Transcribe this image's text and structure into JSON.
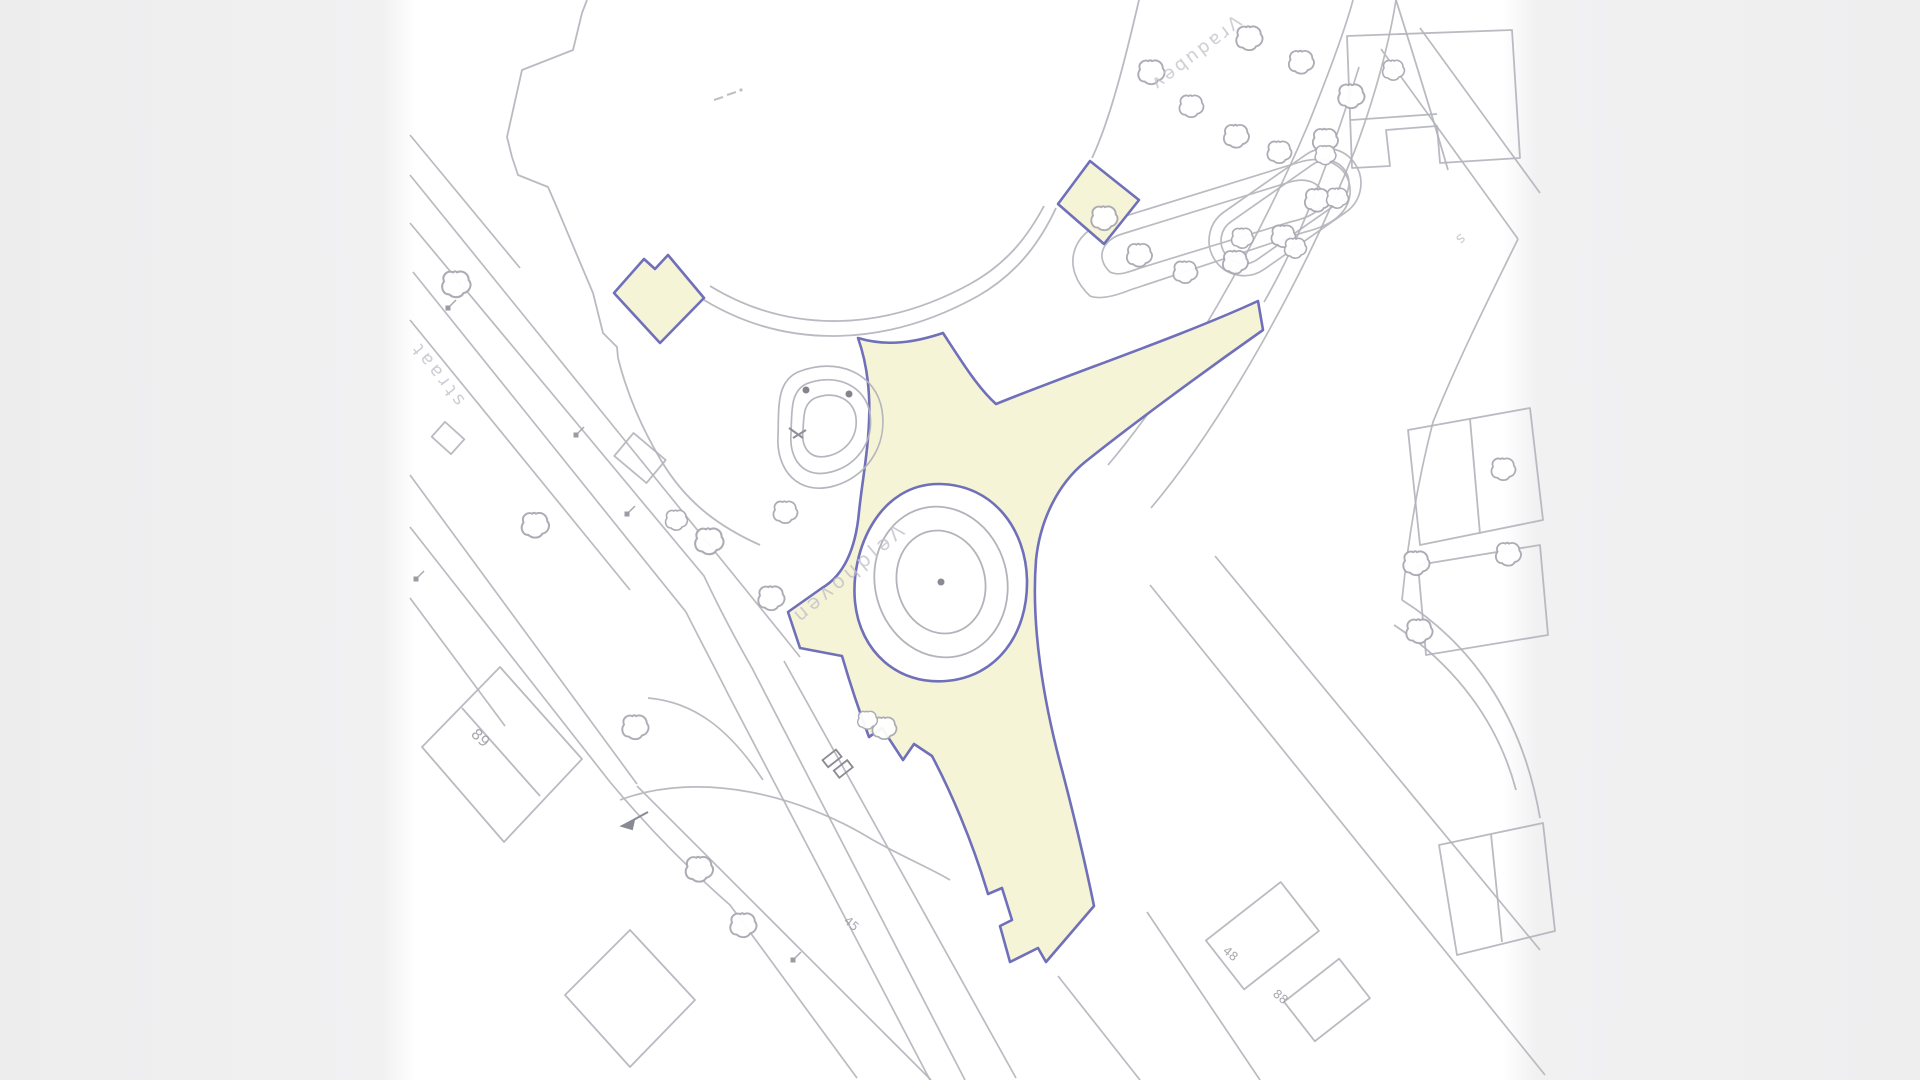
{
  "viewer": {
    "type": "cadastral-site-plan",
    "background": "#ffffff",
    "side_panel_color": "#f0f0f1"
  },
  "palette": {
    "line_gray": "#b3b3bb",
    "line_gray_faint": "#c9c9d0",
    "line_gray_dark": "#8a8a94",
    "plan_blue": "#6f6fba",
    "plan_yellow": "#f6f4d7",
    "label_gray": "#c1c1c9",
    "number_gray": "#9a9aa4"
  },
  "labels": {
    "street_left": {
      "text": "ʇɐɐɹʇs",
      "note": "rotated street name, partially hidden"
    },
    "street_center": {
      "text": "uǝʌoɥplǝΛ",
      "note": "rotated upside-down street name along yellow road"
    },
    "street_topright": {
      "text": "ʌǝqnpɐɹΛ",
      "note": "rotated upside-down street name, top right"
    },
    "small_s": {
      "text": "s"
    },
    "house_numbers": [
      {
        "text": "89"
      },
      {
        "text": "45"
      },
      {
        "text": "48"
      },
      {
        "text": "88"
      }
    ]
  },
  "features": [
    "highlight-area-main-junction",
    "highlight-patch-upper-left",
    "highlight-patch-upper-right",
    "roundabout-island",
    "planter-island-with-trees",
    "plaza-edge-arcs",
    "nw-street-lines",
    "se-street-lines",
    "ne-curved-roads",
    "buildings",
    "tree-symbols",
    "lamp-symbols"
  ]
}
